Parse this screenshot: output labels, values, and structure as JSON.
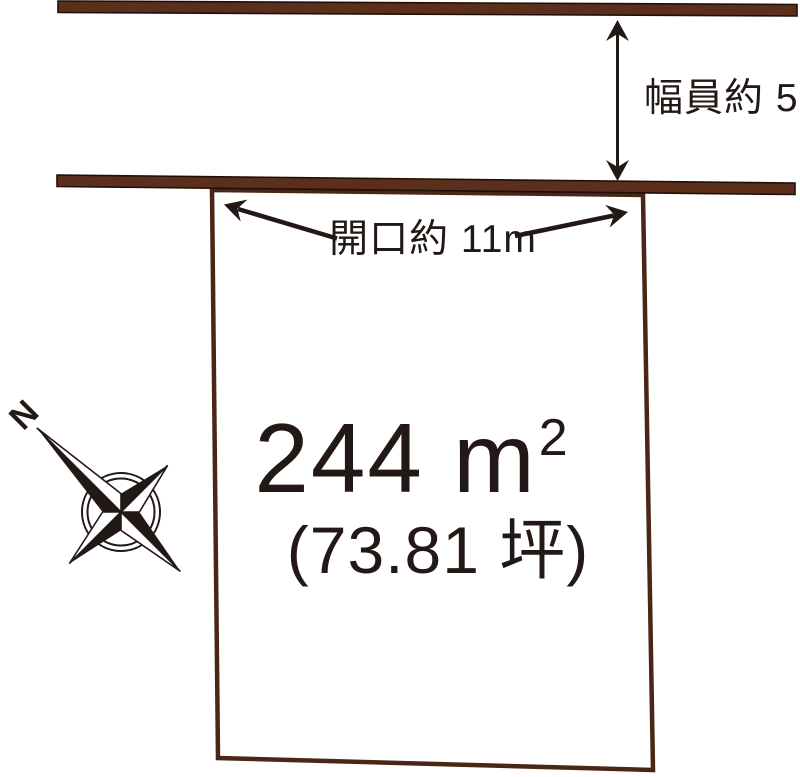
{
  "diagram": {
    "road": {
      "width_label": "幅員約 5m"
    },
    "plot": {
      "frontage_label": "開口約 11m",
      "area_value": "244 m",
      "area_exponent": "2",
      "area_tsubo": "(73.81 坪)"
    },
    "compass": {
      "north_label": "N"
    }
  },
  "colors": {
    "road_fill": "#5b2f1c",
    "road_edge": "#200f08",
    "plot_stroke": "#4a2616",
    "ink": "#221815"
  }
}
